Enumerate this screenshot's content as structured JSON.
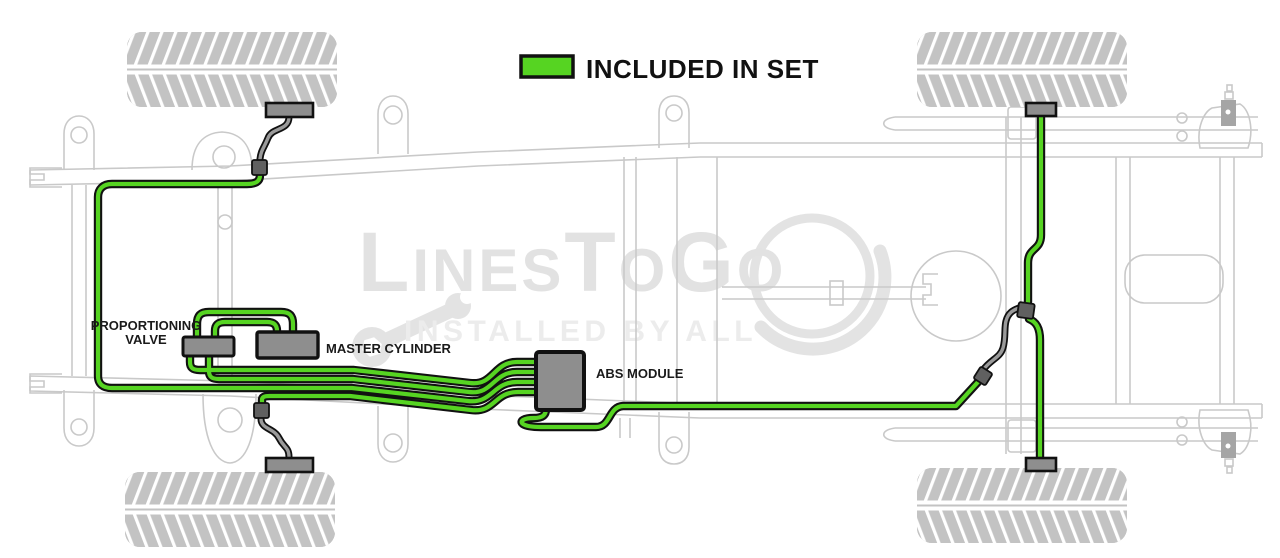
{
  "legend": {
    "label": "INCLUDED IN SET",
    "swatch_color": "#56d422"
  },
  "component_labels": {
    "proportioning_valve_line1": "PROPORTIONING",
    "proportioning_valve_line2": "VALVE",
    "master_cylinder": "MASTER CYLINDER",
    "abs_module": "ABS MODULE"
  },
  "watermark": {
    "brand_part1": "L",
    "brand_part2": "INES",
    "brand_part3": "T",
    "brand_part4": "O",
    "brand_part5": "G",
    "brand_part6": "O",
    "tagline": "INSTALLED BY ALL"
  },
  "colors": {
    "included_green": "#56d422",
    "outline_black": "#111111",
    "chassis_gray": "#c9c9c9",
    "component_fill_gray": "#8e8e8e",
    "hose_gray": "#9a9a9a",
    "connector_dark_gray": "#606060",
    "tire_gray": "#c3c3c3",
    "watermark_gray": "#e3e3e3"
  }
}
